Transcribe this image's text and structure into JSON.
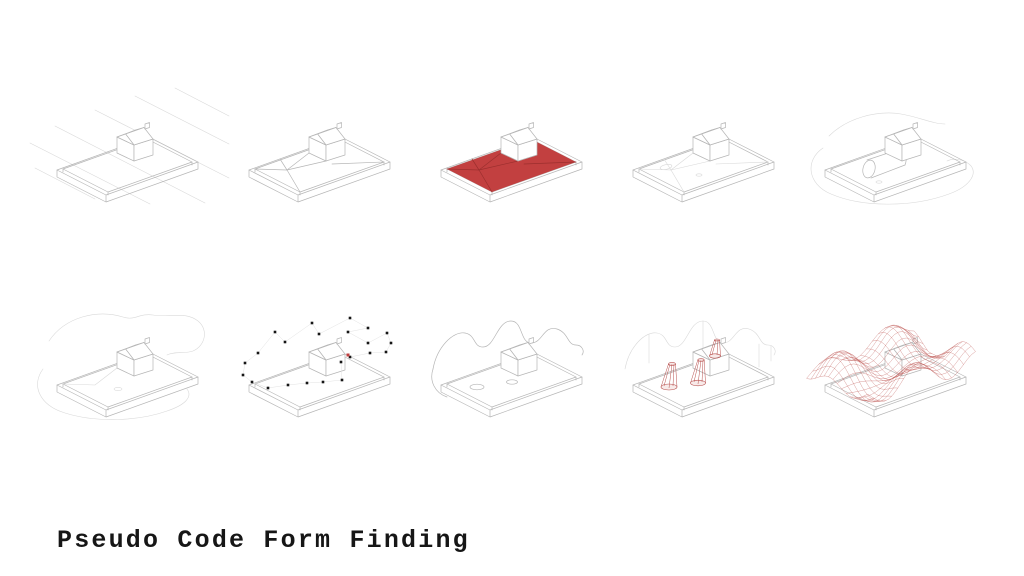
{
  "title": "Pseudo Code Form Finding",
  "colors": {
    "paper_white": "#ffffff",
    "line_gray": "#b6b6b6",
    "faint_gray": "#d9d9d9",
    "surface_red": "#c24040",
    "crease_dark_red": "#9c2f2e",
    "cone_red": "#b8504e",
    "mesh_red": "#c05a58",
    "ink_black": "#161616"
  },
  "figures": [
    {
      "name": "step-1-site-with-context-lines"
    },
    {
      "name": "step-2-site-surface-triangulated"
    },
    {
      "name": "step-3-surface-area-highlighted-red"
    },
    {
      "name": "step-4-surface-relaxed"
    },
    {
      "name": "step-5-context-cylinder-and-blobs"
    },
    {
      "name": "step-6-context-blob-curves"
    },
    {
      "name": "step-7-control-point-cloud"
    },
    {
      "name": "step-8-wavy-boundary-curves"
    },
    {
      "name": "step-9-red-attractor-cones"
    },
    {
      "name": "step-10-form-found-wireframe-mesh"
    }
  ],
  "step_count": 10
}
